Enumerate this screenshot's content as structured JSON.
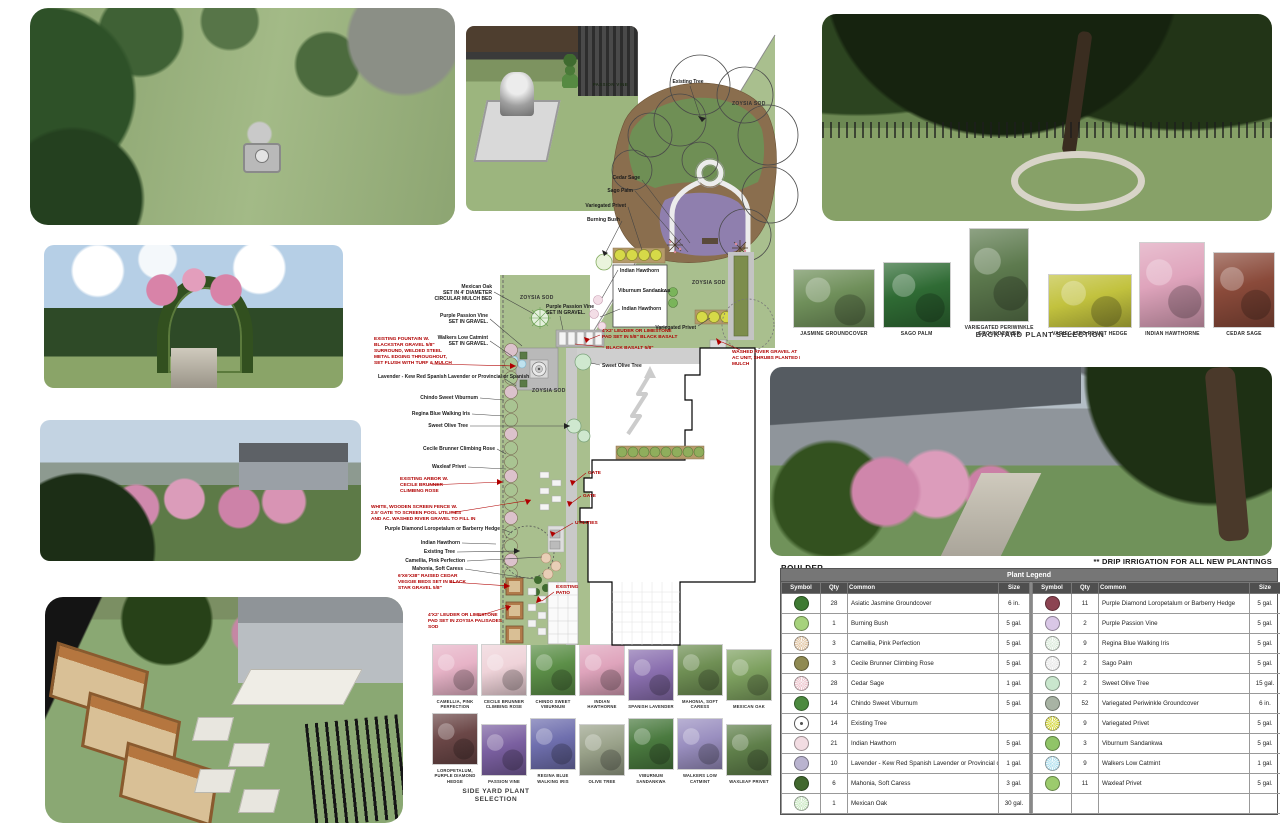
{
  "notes": {
    "drip": "** DRIP IRRIGATION FOR ALL NEW PLANTINGS",
    "boulder": "BOULDER"
  },
  "watermark": {
    "passion_vine": "PASSION VINE"
  },
  "colors": {
    "annotation_red": "#b00000",
    "plan_grass": "#a9bf8e",
    "mulch": "#8a6e4e",
    "periwinkle_purple": "#8f7fae",
    "groundcover_green": "#6f8f55"
  },
  "plan": {
    "sod_label": "ZOYSIA SOD",
    "black": {
      "existing_tree_top": "Existing Tree",
      "cedar_sage": "Cedar Sage",
      "sago_palm": "Sago Palm",
      "variegated_privet": "Variegated Privet",
      "burning_bush": "Burning Bush",
      "indian_hawthorn": "Indian Hawthorn",
      "viburnum_sandankwa": "Viburnum Sandankwa",
      "mexican_oak": [
        "Mexican Oak",
        "SET IN 4' DIAMETER",
        "CIRCULAR MULCH BED"
      ],
      "purple_passion": [
        "Purple Passion Vine",
        "SET IN GRAVEL."
      ],
      "catmint": [
        "Walkers Low Catmint",
        "SET IN GRAVEL."
      ],
      "lavender": "Lavender - Kew Red Spanish Lavender or Provincial or Spanish",
      "chindo": "Chindo Sweet Viburnum",
      "iris": "Regina Blue Walking Iris",
      "sweet_olive": "Sweet Olive Tree",
      "cecile": "Cecile Brunner Climbing Rose",
      "waxleaf": "Waxleaf Privet",
      "loropetalum": "Purple Diamond Loropetalum or Barberry Hedge",
      "existing_tree_side": "Existing Tree",
      "camellia": "Camellia, Pink Perfection",
      "mahonia": "Mahonia, Soft Caress"
    },
    "red": {
      "fountain": [
        "EXISTING FOUNTAIN W.",
        "BLACKSTAR GRAVEL 5/8\"",
        "SURROUND, WELDED STEEL",
        "METAL EDGING THROUGHOUT,",
        "SET FLUSH WITH TURF & MULCH"
      ],
      "arbor": [
        "EXISTING ARBOR W.",
        "CECILE BRUNNER",
        "CLIMBING ROSE"
      ],
      "fence": [
        "WHITE, WOODEN SCREEN FENCE W.",
        "2.5' GATE TO SCREEN POOL UTILITIES",
        "AND AC. WASHED RIVER GRAVEL TO FILL IN"
      ],
      "veggie": [
        "6'X6'X38\" RAISED CEDAR",
        "VEGGIE BEDS SET IN BLACK",
        "STAR GRAVEL 5/8\""
      ],
      "pad_sod": [
        "4'X2' LEUDER OR LIMESTONE",
        "PAD SET IN ZOYSIA PALISADES",
        "SOD"
      ],
      "patio": [
        "EXISTING",
        "PATIO"
      ],
      "pad_basalt": [
        "4'X2' LEUDER OR LIMESTONE",
        "PAD SET IN 5/8\" BLACK BASALT"
      ],
      "basalt": "BLACK BASALT 5/8\"",
      "river_gravel": [
        "WASHED RIVER GRAVEL AT",
        "AC UNIT, SHRUBS PLANTED IN",
        "MULCH"
      ],
      "gate": "GATE",
      "utilities": "UTILITIES"
    }
  },
  "backyard_selection": {
    "caption": "BACKYARD PLANT SELECTION",
    "items": [
      {
        "label": "JASMINE GROUNDCOVER",
        "tone": "#6f8f5a"
      },
      {
        "label": "SAGO PALM",
        "tone": "#2f6b34"
      },
      {
        "label": "VARIEGATED PERIWINKLE GROUNDCOVER",
        "tone": "#5d7a4e"
      },
      {
        "label": "VARIEGATED PRIVET HEDGE",
        "tone": "#c2c23e"
      },
      {
        "label": "INDIAN HAWTHORNE",
        "tone": "#dfa4bc"
      },
      {
        "label": "CEDAR SAGE",
        "tone": "#8a4a3a"
      }
    ]
  },
  "sideyard_selection": {
    "caption_line1": "SIDE YARD PLANT",
    "caption_line2": "SELECTION",
    "row1": [
      {
        "label": "CAMELLIA, PINK PERFECTION",
        "tone": "#e7b3c7"
      },
      {
        "label": "CECILE BRUNNER CLIMBING ROSE",
        "tone": "#efd3d9"
      },
      {
        "label": "CHINDO SWEET VIBURNUM",
        "tone": "#5c8f48"
      },
      {
        "label": "INDIAN HAWTHORNE",
        "tone": "#dfa4bc"
      },
      {
        "label": "SPANISH LAVENDER",
        "tone": "#8a6faf"
      },
      {
        "label": "MAHONIA, SOFT CARESS",
        "tone": "#6f8f54"
      },
      {
        "label": "MEXICAN OAK",
        "tone": "#7da05f"
      }
    ],
    "row2": [
      {
        "label": "LOROPETALUM, PURPLE DIAMOND HEDGE",
        "tone": "#6b4747"
      },
      {
        "label": "PASSION VINE",
        "tone": "#7a5fa0"
      },
      {
        "label": "REGINA BLUE WALKING IRIS",
        "tone": "#6f6fae"
      },
      {
        "label": "OLIVE TREE",
        "tone": "#9aa28a"
      },
      {
        "label": "VIBURNUM SANDANKWA",
        "tone": "#4a7a3f"
      },
      {
        "label": "WALKERS LOW CATMINT",
        "tone": "#9a8fc0"
      },
      {
        "label": "WAXLEAF PRIVET",
        "tone": "#5f7f4a"
      }
    ]
  },
  "legend": {
    "title": "Plant Legend",
    "headers": [
      "Symbol",
      "Qty",
      "Common",
      "Size"
    ],
    "left": [
      {
        "qty": "28",
        "common": "Asiatic Jasmine Groundcover",
        "size": "6 in.",
        "sym": "#3e7a33",
        "burst": false
      },
      {
        "qty": "1",
        "common": "Burning Bush",
        "size": "5 gal.",
        "sym": "#a6d27c",
        "burst": false
      },
      {
        "qty": "3",
        "common": "Camellia, Pink Perfection",
        "size": "5 gal.",
        "sym": "#e3c8a8",
        "burst": true
      },
      {
        "qty": "3",
        "common": "Cecile Brunner Climbing Rose",
        "size": "5 gal.",
        "sym": "#8f8a52",
        "burst": false
      },
      {
        "qty": "28",
        "common": "Cedar Sage",
        "size": "1 gal.",
        "sym": "#eec7cf",
        "burst": true
      },
      {
        "qty": "14",
        "common": "Chindo Sweet Viburnum",
        "size": "5 gal.",
        "sym": "#4c8a3f",
        "burst": false
      },
      {
        "qty": "14",
        "common": "Existing Tree",
        "size": "",
        "sym": "#ffffff",
        "outline": true
      },
      {
        "qty": "21",
        "common": "Indian Hawthorn",
        "size": "5 gal.",
        "sym": "#f2dce2",
        "burst": false
      },
      {
        "qty": "10",
        "common": "Lavender - Kew Red Spanish Lavender or Provincial or Spanish",
        "size": "1 gal.",
        "sym": "#b9b3cf",
        "burst": false
      },
      {
        "qty": "6",
        "common": "Mahonia, Soft Caress",
        "size": "3 gal.",
        "sym": "#41682e",
        "burst": false
      },
      {
        "qty": "1",
        "common": "Mexican Oak",
        "size": "30 gal.",
        "sym": "#cdeac6",
        "burst": true
      }
    ],
    "right": [
      {
        "qty": "11",
        "common": "Purple Diamond Loropetalum or Barberry Hedge",
        "size": "5 gal.",
        "sym": "#8c4452",
        "burst": false
      },
      {
        "qty": "2",
        "common": "Purple Passion Vine",
        "size": "5 gal.",
        "sym": "#d9c7e6",
        "burst": false
      },
      {
        "qty": "9",
        "common": "Regina Blue Walking Iris",
        "size": "5 gal.",
        "sym": "#dcebdc",
        "burst": true
      },
      {
        "qty": "2",
        "common": "Sago Palm",
        "size": "5 gal.",
        "sym": "#e9e9e9",
        "burst": true
      },
      {
        "qty": "2",
        "common": "Sweet Olive Tree",
        "size": "15 gal.",
        "sym": "#c9e6cd",
        "burst": false
      },
      {
        "qty": "52",
        "common": "Variegated Periwinkle Groundcover",
        "size": "6 in.",
        "sym": "#a8b3a4",
        "burst": false
      },
      {
        "qty": "9",
        "common": "Variegated Privet",
        "size": "5 gal.",
        "sym": "#d6d948",
        "burst": true
      },
      {
        "qty": "3",
        "common": "Viburnum Sandankwa",
        "size": "5 gal.",
        "sym": "#90c468",
        "burst": false
      },
      {
        "qty": "9",
        "common": "Walkers Low Catmint",
        "size": "1 gal.",
        "sym": "#b5e2f0",
        "burst": true
      },
      {
        "qty": "11",
        "common": "Waxleaf Privet",
        "size": "5 gal.",
        "sym": "#9ccb6d",
        "burst": false
      }
    ]
  }
}
